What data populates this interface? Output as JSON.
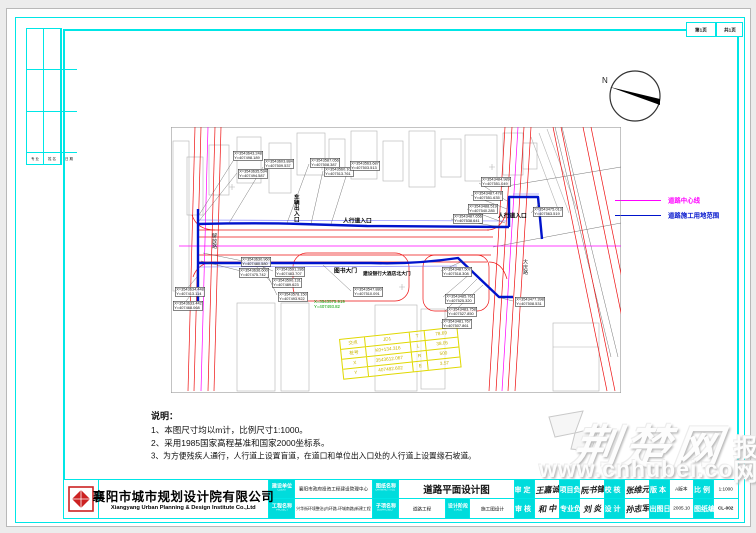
{
  "page": {
    "sheet_no": "第1页",
    "sheet_total": "共1页"
  },
  "compass": {
    "north": "N"
  },
  "signature_strip": {
    "labels": [
      "专 业",
      "姓 名",
      "日 期"
    ]
  },
  "legend": {
    "items": [
      {
        "label": "道路中心线",
        "color": "#ff00ff"
      },
      {
        "label": "道路施工用地范围",
        "color": "#0013cc"
      }
    ]
  },
  "notes": {
    "title": "说明：",
    "lines": [
      "1、本图尺寸均以m计，比例尺寸1:1000。",
      "2、采用1985国家高程基准和国家2000坐标系。",
      "3、为方便残疾人通行，人行道上设置盲道，在道口和单位出入口处的人行道上设置缘石坡道。"
    ]
  },
  "drawing": {
    "labels": {
      "vehicle_entrance": "车辆出入口",
      "ped_entrance_1": "人行道入口",
      "ped_entrance_2": "人行道入口",
      "gate_library": "图书大门",
      "gate_bank": "建设银行大酒店北大门",
      "road_left": "解放路",
      "road_right": "大庆路"
    },
    "green_point": {
      "x": "X=3543575.919",
      "y": "Y=407493.82"
    },
    "coords": [
      {
        "x": "X=3543643.248",
        "y": "Y=407498.189"
      },
      {
        "x": "X=3543603.884",
        "y": "Y=407509.537"
      },
      {
        "x": "X=3543635.534",
        "y": "Y=407494.587"
      },
      {
        "x": "X=3543587.056",
        "y": "Y=407508.387"
      },
      {
        "x": "X=3543560.108",
        "y": "Y=407513.761"
      },
      {
        "x": "X=3543563.687",
        "y": "Y=407503.513"
      },
      {
        "x": "X=3543484.989",
        "y": "Y=407551.049"
      },
      {
        "x": "X=3543487.478",
        "y": "Y=407551.635"
      },
      {
        "x": "X=3543488.519",
        "y": "Y=407540.285"
      },
      {
        "x": "X=3543487.656",
        "y": "Y=407538.641"
      },
      {
        "x": "X=3543475.013",
        "y": "Y=407563.519"
      },
      {
        "x": "X=3543630.960",
        "y": "Y=407480.580"
      },
      {
        "x": "X=3543636.600",
        "y": "Y=407475.742"
      },
      {
        "x": "X=3543591.286",
        "y": "Y=407483.707"
      },
      {
        "x": "X=3543590.131",
        "y": "Y=407489.623"
      },
      {
        "x": "X=3543578.150",
        "y": "Y=407493.922"
      },
      {
        "x": "X=3543634.448",
        "y": "Y=407413.114"
      },
      {
        "x": "X=3543633.442",
        "y": "Y=407468.068"
      },
      {
        "x": "X=3543547.880",
        "y": "Y=407510.091"
      },
      {
        "x": "X=3543487.507",
        "y": "Y=407518.308"
      },
      {
        "x": "X=3543485.761",
        "y": "Y=407525.320"
      },
      {
        "x": "X=3543483.758",
        "y": "Y=407527.850"
      },
      {
        "x": "X=3543481.767",
        "y": "Y=407507.861"
      },
      {
        "x": "X=3543477.398",
        "y": "Y=407508.531"
      }
    ],
    "curve_table": {
      "rows": [
        [
          "交点",
          "JD1",
          "T",
          "78.69"
        ],
        [
          "桩号",
          "K0+134.316",
          "L",
          "38.05"
        ],
        [
          "X",
          "3543612.067",
          "R",
          "500"
        ],
        [
          "Y",
          "407482.602",
          "E",
          "3.57"
        ]
      ]
    }
  },
  "titleblock": {
    "company_cn": "襄阳市城市规划设计院有限公司",
    "company_en": "Xiangyang Urban Planning & Design Institute Co.,Ltd",
    "client_label": "建设单位",
    "client_label_en": "CLIENT",
    "client": "襄阳市政府投资工程建设管理中心",
    "project_label": "工程名称",
    "project_label_en": "PROJECT",
    "project": "兴华街环境整治(内环路-环城南路)新建工程",
    "title_label": "图纸名称",
    "title_label_en": "DRAWING TITLE",
    "title": "道路平面设计图",
    "sub_label": "子项名称",
    "sub_label_en": "SUBPROJECT",
    "sub": "道路工程",
    "stage_label": "设计阶段",
    "stage_label_en": "STAGE",
    "stage": "施工图设计",
    "approved_label": "审 定",
    "approved_label_en": "APPROVED",
    "approved_sig": "王嘉诚",
    "examined_label": "审 核",
    "examined_label_en": "EXAMINED",
    "examined_sig": "和 中",
    "pm_label": "项目负责",
    "pm_label_en": "PROJ MGR",
    "pm_sig": "阮书锋",
    "pro_label": "专业负责",
    "pro_label_en": "DISCIPLINE",
    "pro_sig": "刘 炎",
    "checked_label": "校 核",
    "checked_label_en": "CHECKED",
    "checked_sig": "张维元",
    "designed_label": "设 计",
    "designed_label_en": "DESIGNED",
    "designed_sig": "孙志军",
    "edition_label": "版 本",
    "edition_label_en": "EDITION",
    "edition": "A版本",
    "scale_label": "比 例",
    "scale_label_en": "SCALE",
    "scale": "1:1000",
    "date_label": "出图日期",
    "date_label_en": "DATE",
    "date": "2005.10",
    "no_label": "图纸编号",
    "no_label_en": "DRAWING No.",
    "no": "CL-002"
  },
  "watermark": {
    "logo_text": "荆楚网",
    "url": "www.cnhubei.com",
    "side": "报网"
  }
}
